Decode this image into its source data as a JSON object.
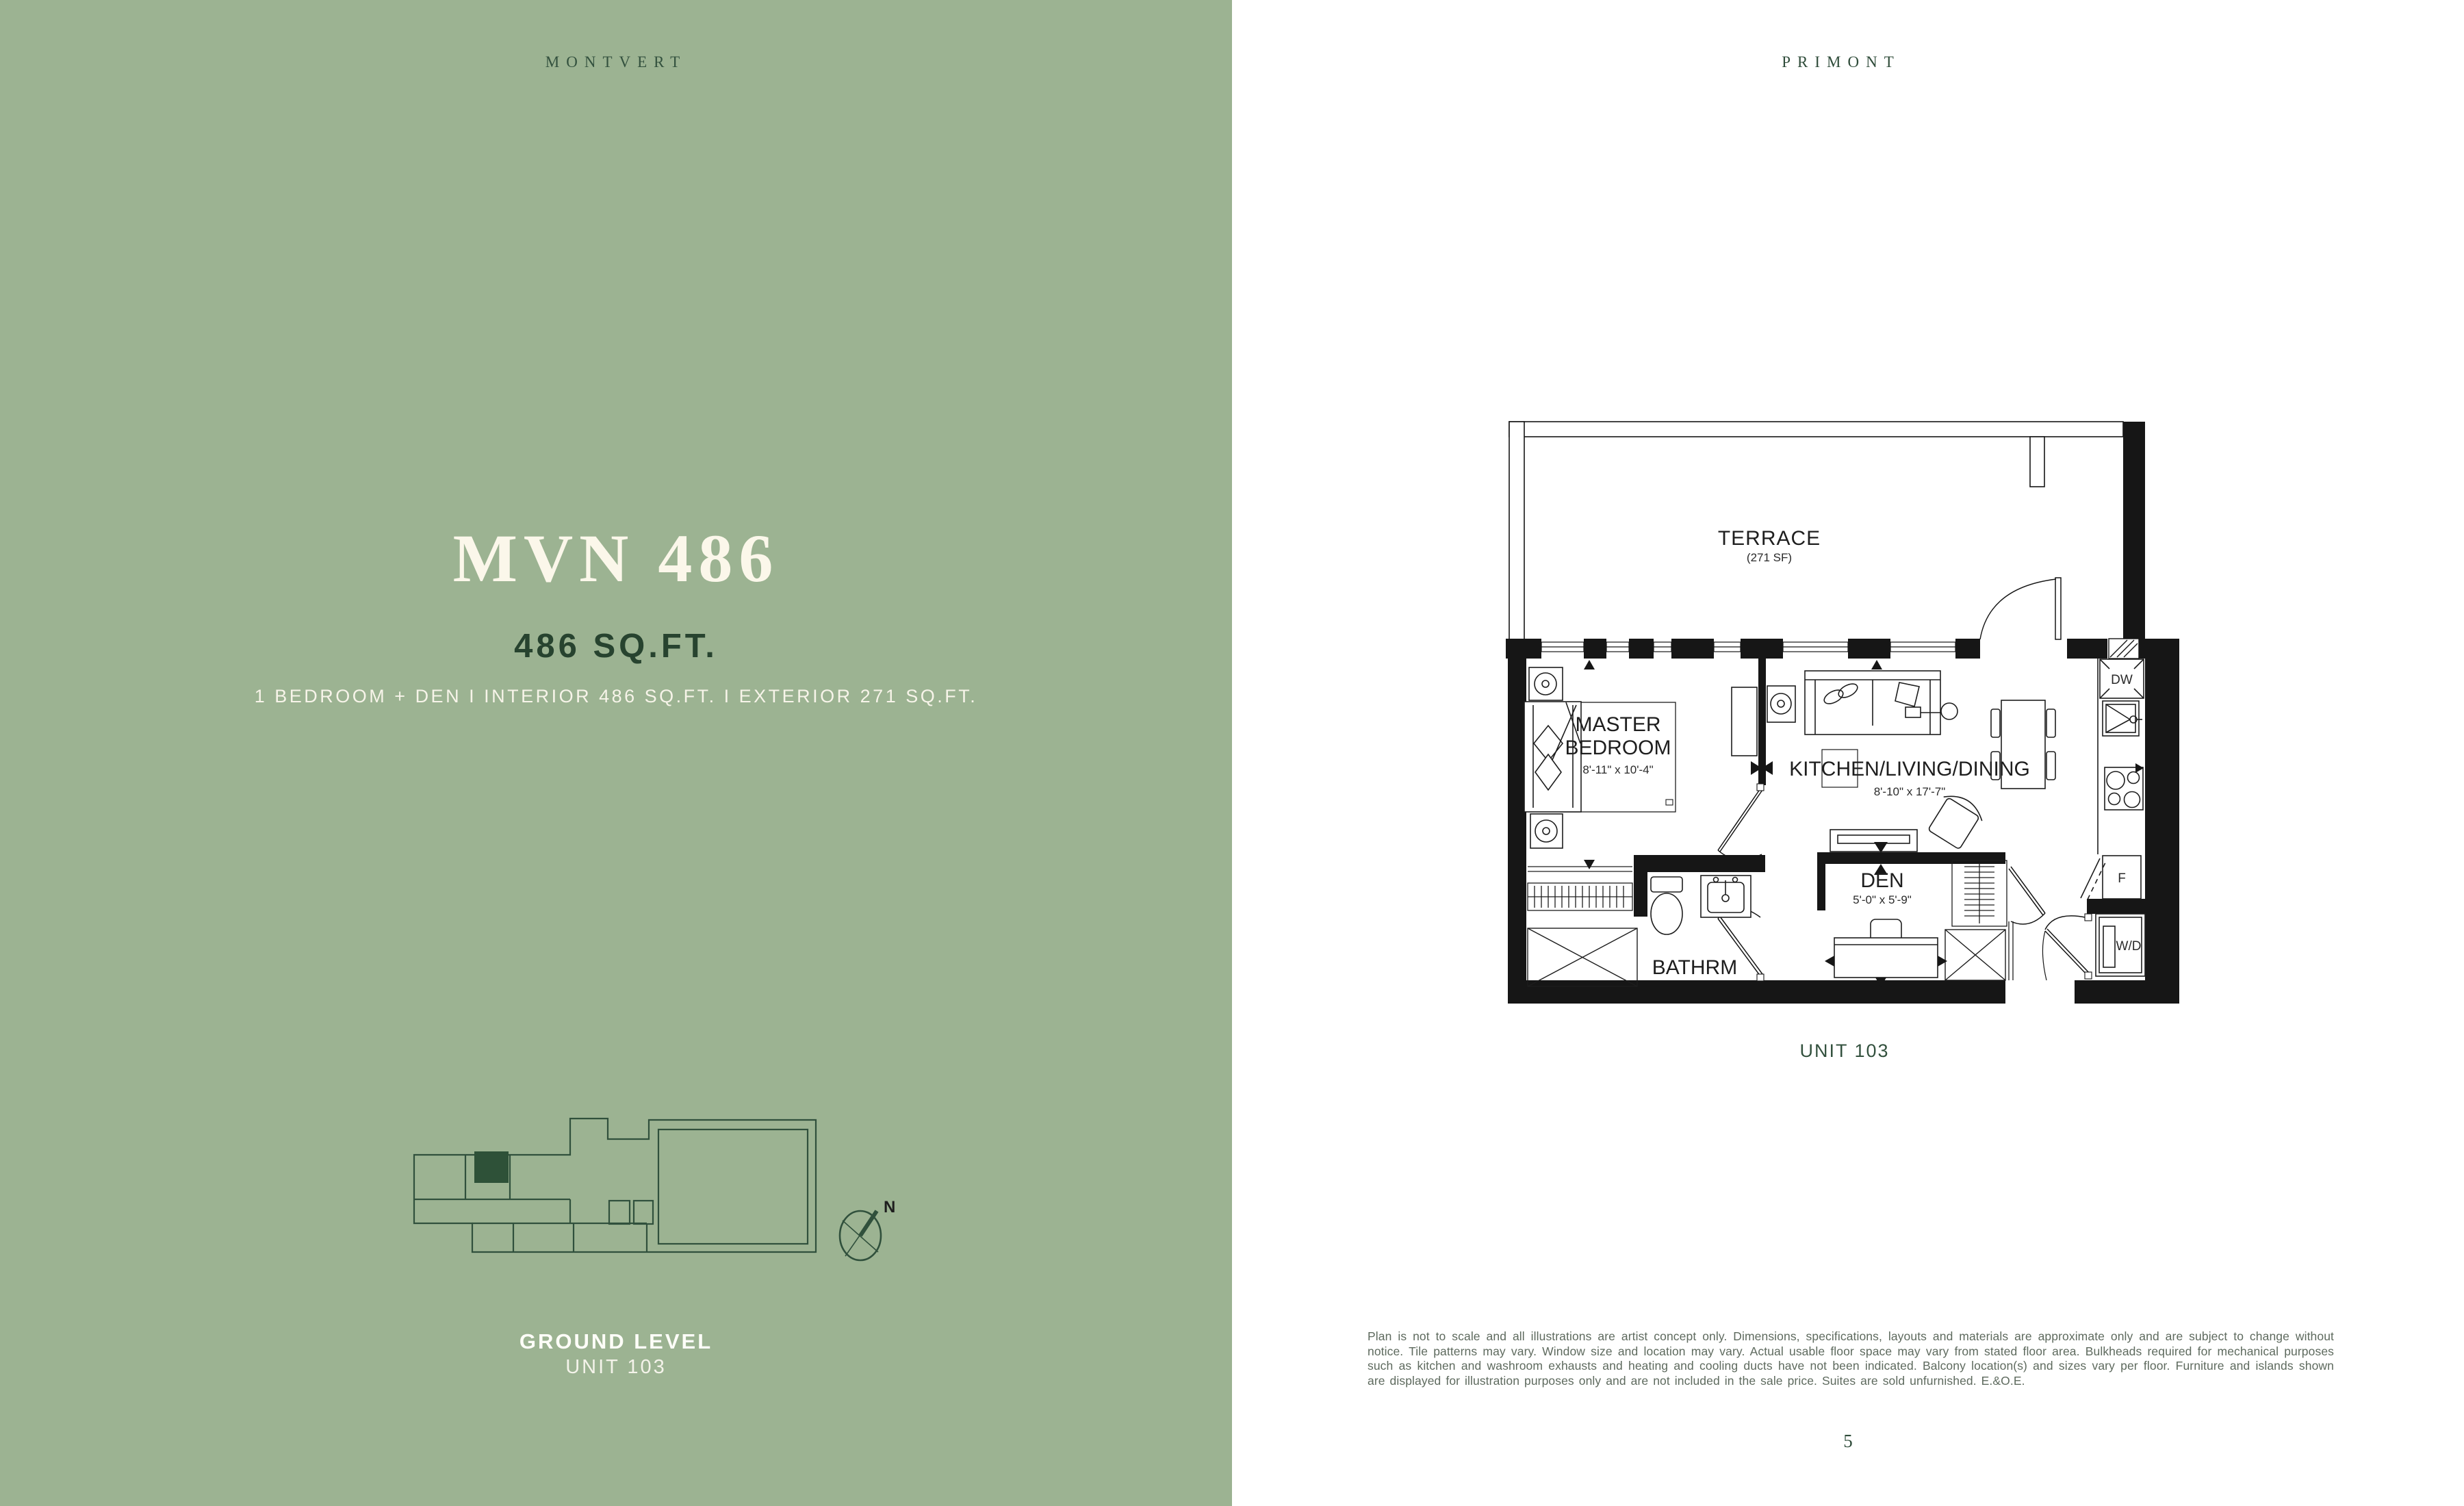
{
  "left_panel": {
    "brand": "MONTVERT",
    "title": "MVN 486",
    "area_headline": "486 SQ.FT.",
    "details": "1 BEDROOM + DEN  I  INTERIOR 486 SQ.FT.  I  EXTERIOR 271 SQ.FT.",
    "level_label": "GROUND LEVEL",
    "unit_label": "UNIT 103",
    "compass_north": "N",
    "colors": {
      "background": "#9CB392",
      "dark_green": "#2F4C3A",
      "cream": "#FBF7EA",
      "highlight_unit": "#2E5138"
    }
  },
  "right_panel": {
    "brand": "PRIMONT",
    "unit_caption": "UNIT 103",
    "page_number": "5",
    "disclaimer": "Plan is not to scale and all illustrations are artist concept only. Dimensions, specifications, layouts and materials are approximate only and are subject to change without notice. Tile patterns may vary. Window size and location may vary. Actual usable floor space may vary from stated floor area. Bulkheads required for mechanical purposes such as kitchen and washroom exhausts and heating and cooling ducts have not been indicated. Balcony location(s) and sizes vary per floor. Furniture and islands shown are displayed for illustration purposes only and are not included in the sale price. Suites are sold unfurnished. E.&O.E.",
    "floor_plan": {
      "rooms": {
        "terrace": {
          "name": "TERRACE",
          "area": "(271 SF)"
        },
        "master_bedroom": {
          "line1": "MASTER",
          "line2": "BEDROOM",
          "dims": "8'-11\" x 10'-4\""
        },
        "kitchen_living_dining": {
          "name": "KITCHEN/LIVING/DINING",
          "dims": "8'-10\" x 17'-7\""
        },
        "den": {
          "name": "DEN",
          "dims": "5'-0\" x 5'-9\""
        },
        "bathroom": {
          "name": "BATHRM"
        }
      },
      "appliances": {
        "dishwasher": "DW",
        "fridge": "F",
        "washer_dryer": "W/D"
      }
    }
  }
}
